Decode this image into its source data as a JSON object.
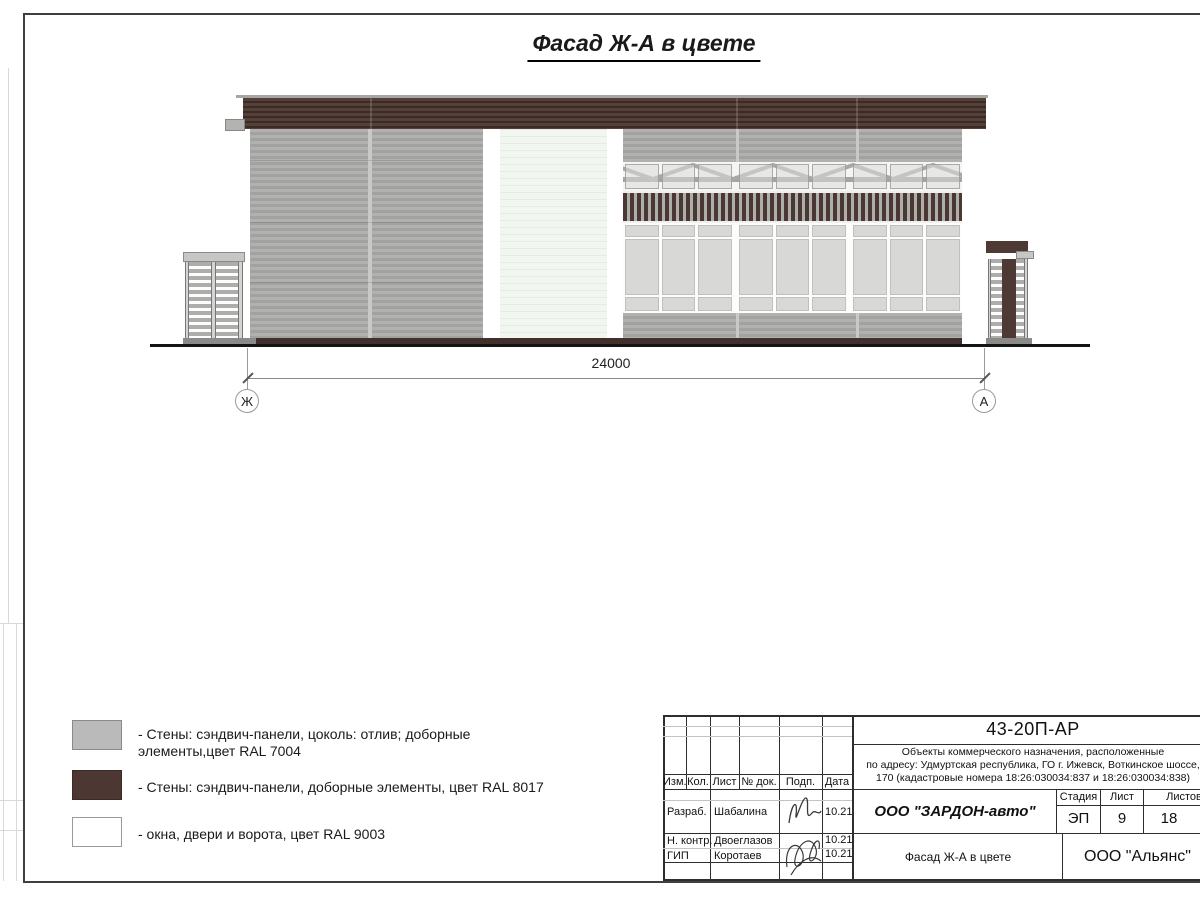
{
  "sheet": {
    "title": "Фасад Ж-А в цвете"
  },
  "dimension": {
    "value": "24000",
    "axis_left": "Ж",
    "axis_right": "А"
  },
  "legend": {
    "items": [
      {
        "swatch_color": "#bababa",
        "label": "- Стены: сэндвич-панели, цоколь: отлив; доборные элементы,цвет RAL 7004"
      },
      {
        "swatch_color": "#4c3733",
        "label": "- Стены: сэндвич-панели, доборные элементы, цвет RAL 8017"
      },
      {
        "swatch_color": "#ffffff",
        "label": "- окна, двери и ворота, цвет RAL 9003"
      }
    ]
  },
  "facade_colors": {
    "gray_ral7004": "#adadab",
    "brown_ral8017": "#4c3834",
    "white_ral9003": "#f2f6f1"
  },
  "title_block": {
    "doc_number": "43-20П-АР",
    "project_description": {
      "line1": "Объекты коммерческого назначения, расположенные",
      "line2": "по адресу: Удмуртская республика, ГО г. Ижевск, Воткинское шоссе,",
      "line3": "170 (кадастровые номера 18:26:030034:837 и 18:26:030034:838)"
    },
    "header_cols": [
      "Изм.",
      "Кол.",
      "Лист",
      "№ док.",
      "Подп.",
      "Дата"
    ],
    "rows": [
      {
        "role": "Разраб.",
        "name": "Шабалина",
        "date": "10.21"
      },
      {
        "role": "Н. контр.",
        "name": "Двоеглазов",
        "date": "10.21"
      },
      {
        "role": "ГИП",
        "name": "Коротаев",
        "date": "10.21"
      }
    ],
    "developer": "ООО \"ЗАРДОН-авто\"",
    "stage_header": "Стадия",
    "sheet_header": "Лист",
    "sheets_header": "Листов",
    "stage": "ЭП",
    "sheet_number": "9",
    "sheets_total": "18",
    "drawing_title": "Фасад Ж-А в цвете",
    "org": "ООО \"Альянс\""
  }
}
